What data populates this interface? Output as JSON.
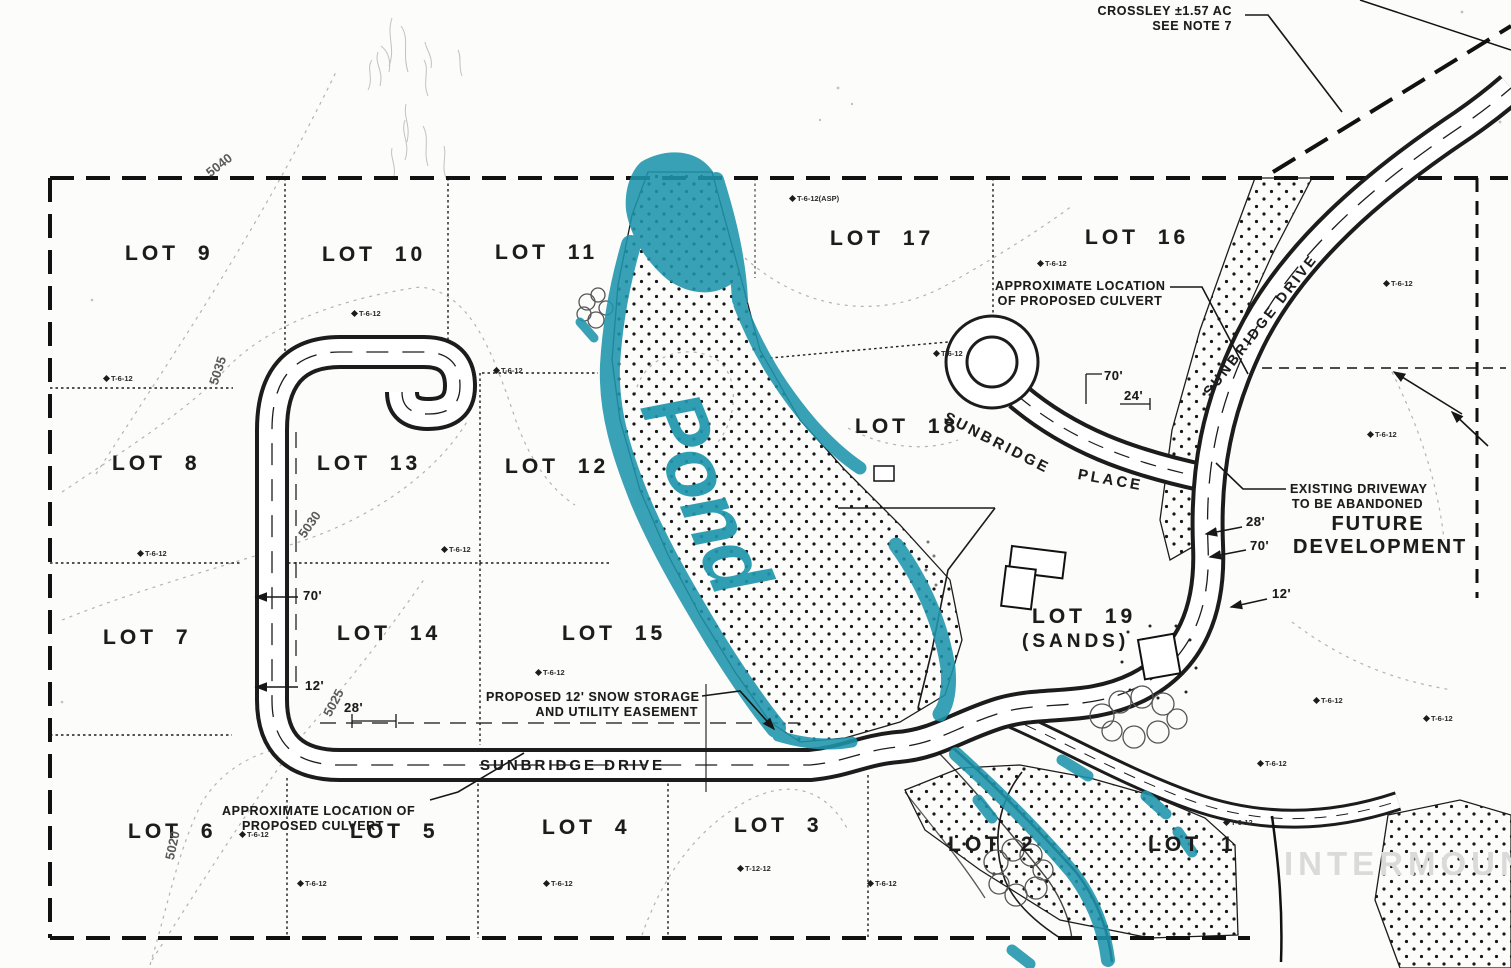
{
  "colors": {
    "teal": "#1e95ac",
    "ink": "#1b1b1b",
    "contour_gray": "#8c8c8c",
    "watermark_gray": "#dadada",
    "paper": "#fcfcfa"
  },
  "lots": [
    {
      "label": "LOT 9"
    },
    {
      "label": "LOT 10"
    },
    {
      "label": "LOT 11"
    },
    {
      "label": "LOT 17"
    },
    {
      "label": "LOT 16"
    },
    {
      "label": "LOT 8"
    },
    {
      "label": "LOT 13"
    },
    {
      "label": "LOT 12"
    },
    {
      "label": "LOT 18"
    },
    {
      "label": "LOT 7"
    },
    {
      "label": "LOT 14"
    },
    {
      "label": "LOT 15"
    },
    {
      "label": "LOT 19",
      "sub": "(SANDS)"
    },
    {
      "label": "LOT 6"
    },
    {
      "label": "LOT 5"
    },
    {
      "label": "LOT 4"
    },
    {
      "label": "LOT 3"
    },
    {
      "label": "LOT 2"
    },
    {
      "label": "LOT 1"
    }
  ],
  "roads": {
    "sunbridge_drive_bottom": "SUNBRIDGE DRIVE",
    "sunbridge_drive_right": "SUNBRIDGE DRIVE",
    "sunbridge_place_line1": "SUNBRIDGE",
    "sunbridge_place_line2": "PLACE"
  },
  "annotations": {
    "crossley_line1": "CROSSLEY ±1.57 AC",
    "crossley_line2": "SEE NOTE 7",
    "culvert_top_line1": "APPROXIMATE LOCATION",
    "culvert_top_line2": "OF PROPOSED CULVERT",
    "culvert_bottom_line1": "APPROXIMATE LOCATION OF",
    "culvert_bottom_line2": "PROPOSED CULVERT",
    "snow_line1": "PROPOSED 12' SNOW STORAGE",
    "snow_line2": "AND UTILITY EASEMENT",
    "driveway_line1": "EXISTING DRIVEWAY",
    "driveway_line2": "TO BE ABANDONED",
    "future_line1": "FUTURE",
    "future_line2": "DEVELOPMENT",
    "pond_note": "Pond",
    "watermark": "INTERMOUNTAIN"
  },
  "contours": {
    "c5040": "5040",
    "c5035": "5035",
    "c5030": "5030",
    "c5025": "5025",
    "c5020": "5020"
  },
  "dimensions": {
    "left_70": "70'",
    "left_12": "12'",
    "left_28": "28'",
    "place_70": "70'",
    "place_24": "24'",
    "right_28": "28'",
    "right_70": "70'",
    "right_12": "12'"
  },
  "markers": [
    {
      "label": "T-6-12"
    },
    {
      "label": "T-6-12"
    },
    {
      "label": "T-6-12"
    },
    {
      "label": "T-6-12"
    },
    {
      "label": "T-6-12"
    },
    {
      "label": "T-6-12(ASP)"
    },
    {
      "label": "T-6-12"
    },
    {
      "label": "T-6-12"
    },
    {
      "label": "T-6-12"
    },
    {
      "label": "T-6-12"
    },
    {
      "label": "T-6-12"
    },
    {
      "label": "T-6-12"
    },
    {
      "label": "T-12-12"
    },
    {
      "label": "T-6-12"
    },
    {
      "label": "T-6-12"
    },
    {
      "label": "T-6-12"
    },
    {
      "label": "T-6-12"
    },
    {
      "label": "T-6-12"
    },
    {
      "label": "T-6-12"
    },
    {
      "label": "T-6-12"
    }
  ]
}
